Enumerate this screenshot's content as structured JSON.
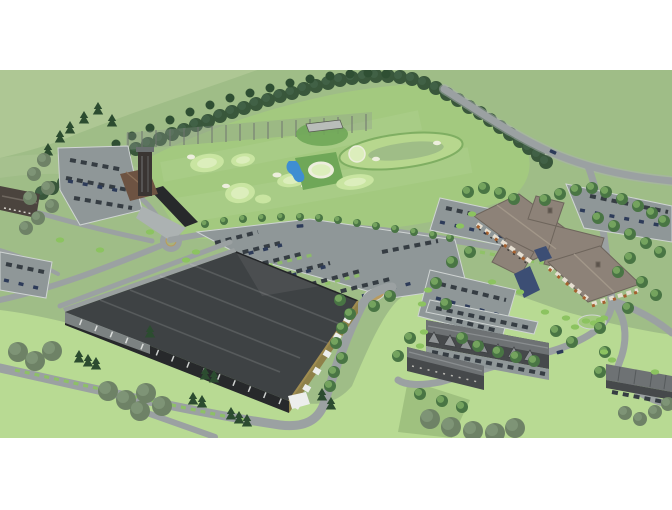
{
  "image": {
    "kind": "aerial 3D architectural site rendering",
    "description_elements": [
      "white letterbox margins",
      "rolling green terrain",
      "tree-lined ridge",
      "perimeter road",
      "driving range with netting and poles",
      "practice putting greens with sand bunkers",
      "small blue pond",
      "fairway loop",
      "range building with tower",
      "west parking lot",
      "left edge building",
      "roundabout",
      "main parking lot with car rows",
      "large dark-roofed indoor facility",
      "clubhouse complex with hipped roofs",
      "blue entrance gable",
      "clubhouse parking lots",
      "landscaped oval island",
      "townhouse rows with gabled garages",
      "garage building",
      "hedges, conifer and deciduous trees",
      "bright lawns"
    ]
  },
  "palette": {
    "white": "#ffffff",
    "terrain_base": "#9fbd87",
    "terrain_hill": "#aec794",
    "terrain_shade": "#8fb078",
    "course_green": "#a3c97f",
    "lawn_bright": "#b8da93",
    "lawn_shade": "#86a86b",
    "green_pad": "#6fa758",
    "putting_green": "#c9e5a1",
    "putting_green_light": "#dceebc",
    "bunker_sand": "#edeedd",
    "pond_blue": "#3f8ed2",
    "road": "#9ba1a2",
    "road_light": "#acb2b2",
    "parking": "#8f9798",
    "curb": "#cfd4d3",
    "roof_dark": "#3e4244",
    "roof_streak": "#5a5e60",
    "wall_dark": "#27292b",
    "wall_tan": "#8f8149",
    "wall_gray": "#9aa0a0",
    "canopy_white": "#eceeec",
    "tower_dark": "#3a3532",
    "range_roof": "#6d5342",
    "left_roof": "#4b443e",
    "clubhouse_roof": "#8d8278",
    "clubhouse_edge": "#6e655c",
    "clubhouse_orange": "#a5602f",
    "clubhouse_cream": "#e6dfd1",
    "clubhouse_blue": "#3c4e74",
    "town_roof": "#6e7274",
    "town_gable": "#8e9294",
    "town_wall": "#46494b",
    "tree_dark": "#2c4c30",
    "tree_mid": "#497544",
    "tree_light": "#74a35e",
    "tree_gray": "#6e8266",
    "hedge": "#8cc360",
    "ridge_tree": "#39573b",
    "car_dark": "#363d43",
    "car_navy": "#2d3b59",
    "car_gray": "#878e91",
    "net_gray": "#8e978f",
    "island_tan": "#b99b5e"
  }
}
